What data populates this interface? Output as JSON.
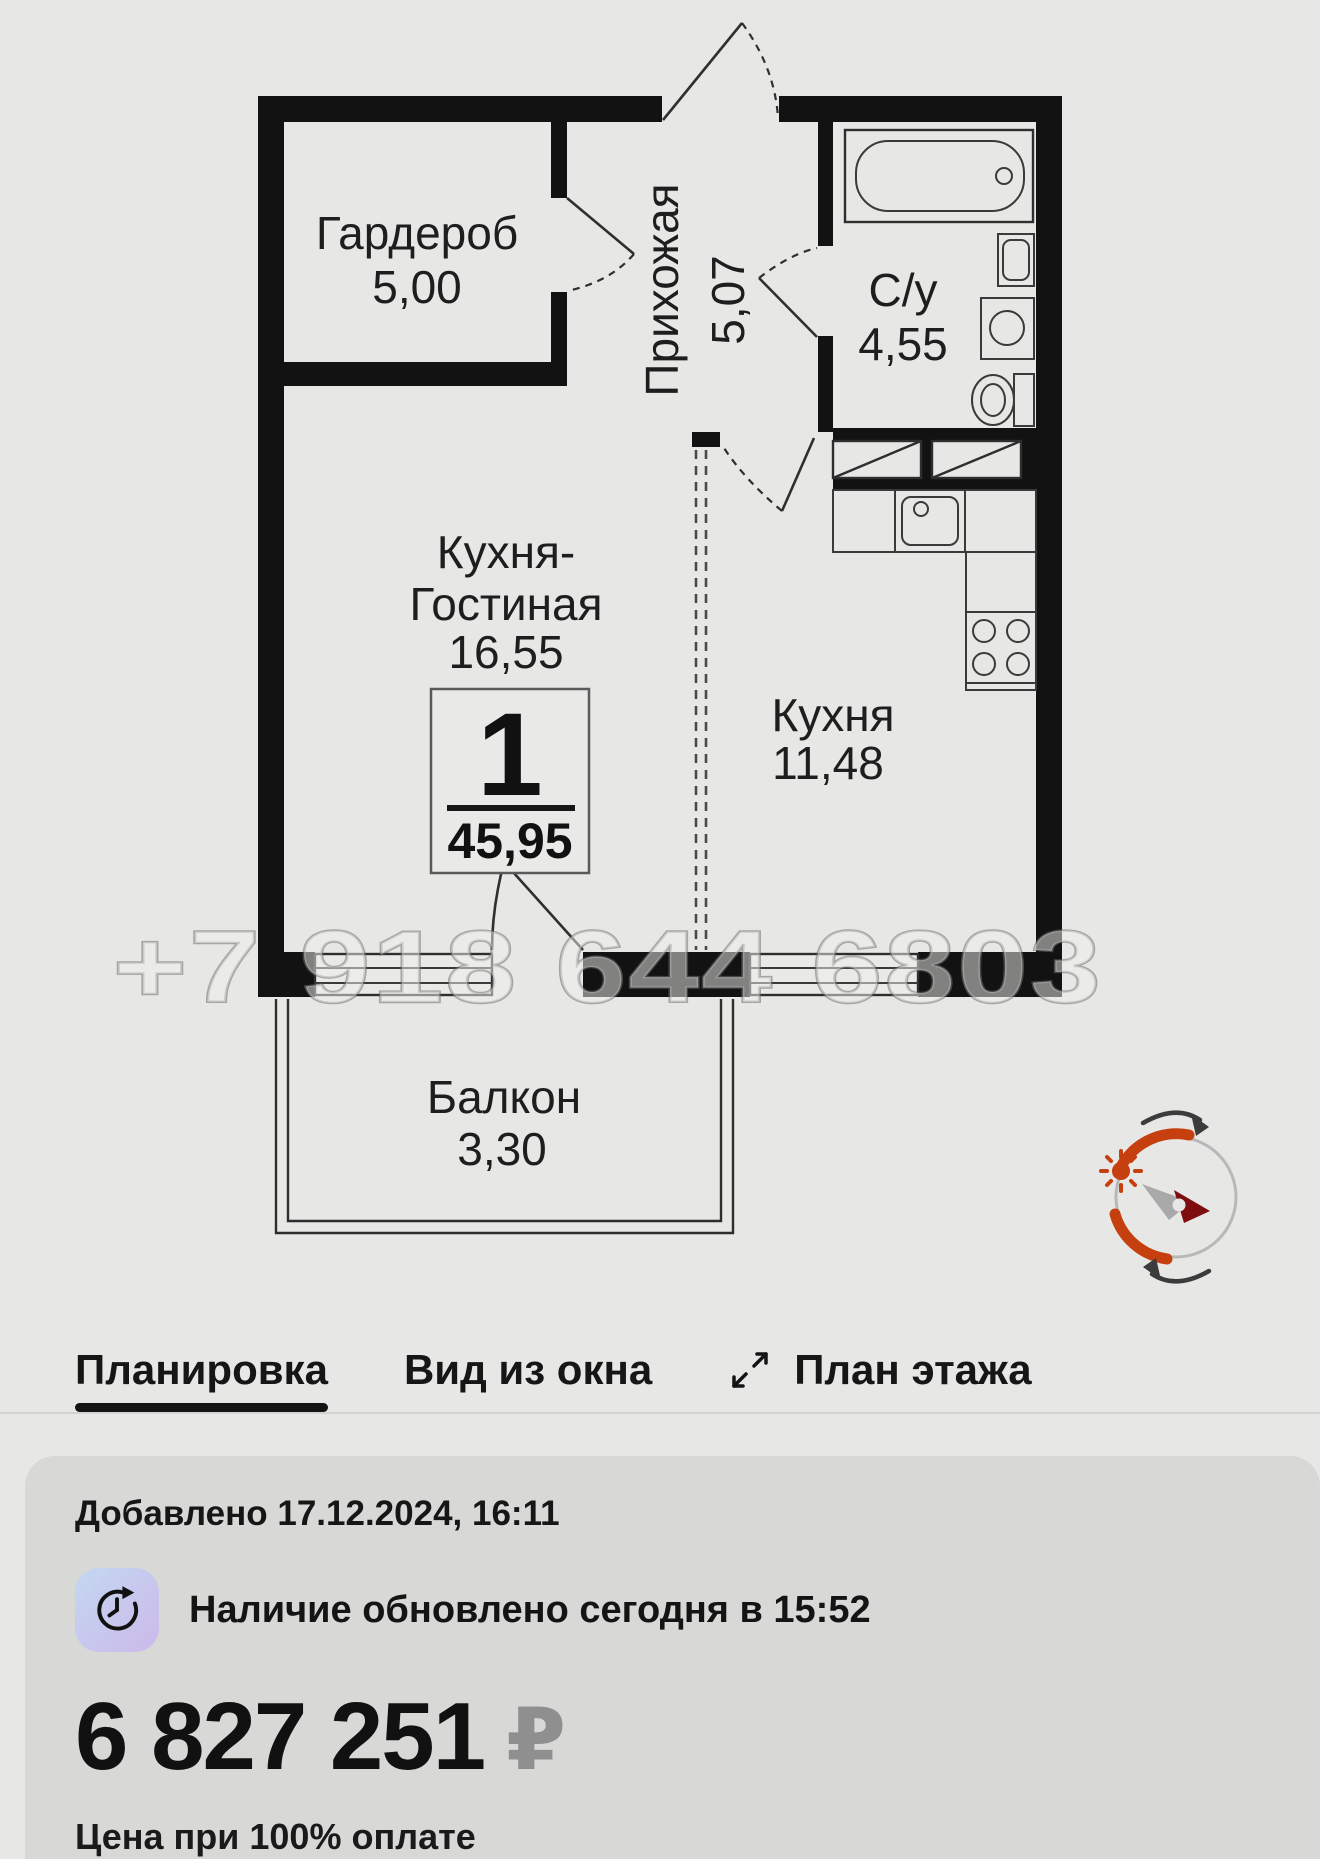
{
  "plan": {
    "watermark": "+7 918 644 6803",
    "rooms": {
      "wardrobe": {
        "name": "Гардероб",
        "area": "5,00"
      },
      "hallway": {
        "name": "Прихожая",
        "area": "5,07"
      },
      "bathroom": {
        "name": "С/у",
        "area": "4,55"
      },
      "kitchen_living": {
        "line1": "Кухня-",
        "line2": "Гостиная",
        "area": "16,55"
      },
      "kitchen": {
        "name": "Кухня",
        "area": "11,48"
      },
      "balcony": {
        "name": "Балкон",
        "area": "3,30"
      }
    },
    "badge": {
      "rooms_count": "1",
      "total_area": "45,95"
    }
  },
  "tabs": {
    "layout": "Планировка",
    "window_view": "Вид из окна",
    "floor_plan": "План этажа"
  },
  "card": {
    "added": "Добавлено 17.12.2024, 16:11",
    "availability": "Наличие обновлено сегодня в 15:52",
    "price": "6 827 251",
    "currency": "₽",
    "price_note": "Цена при 100% оплате"
  },
  "icons": {
    "tab_floor_plan": "expand-arrows-icon",
    "availability": "clock-history-icon",
    "plan_corner": "compass-sun-rotation-icon"
  },
  "colors": {
    "page_bg": "#e7e7e5",
    "card_bg": "#d8d8d6",
    "walls": "#121212",
    "active_tab_underline": "#141414",
    "currency_gray": "#8f8f8f",
    "compass_orange": "#c63f0e",
    "compass_needle_red": "#7e0d10",
    "badge_gradient_start": "#c3d8f1",
    "badge_gradient_end": "#ccb9ea"
  }
}
